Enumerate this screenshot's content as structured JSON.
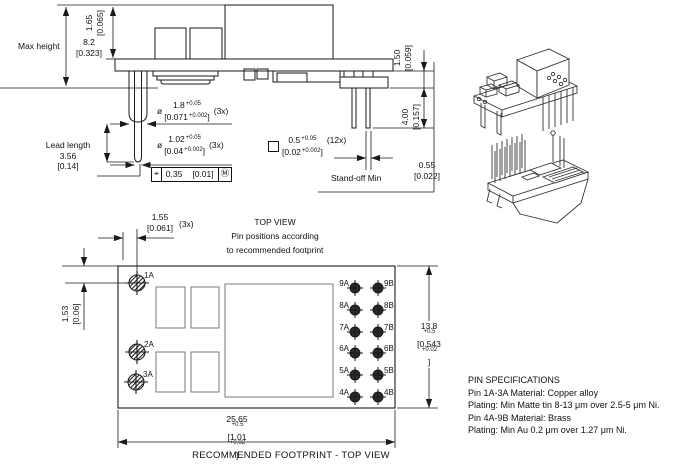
{
  "side_view": {
    "max_height_label": "Max height",
    "dim_board_top": {
      "mm": "1.65",
      "inch": "[0.065]"
    },
    "dim_max_height": {
      "mm": "8.2",
      "inch": "[0.323]"
    },
    "dim_board_right": {
      "mm": "1.50",
      "inch": "[0.059]"
    },
    "dim_pin_length": {
      "mm": "4.00",
      "inch": "[0.157]"
    },
    "lead_length": {
      "label": "Lead length",
      "mm": "3.56",
      "inch": "[0.14]"
    },
    "dia_large": {
      "symbol": "ø",
      "mm": [
        {
          "t": "1.8"
        },
        {
          "t": "+0.05",
          "sup": true
        }
      ],
      "inch": [
        {
          "t": "[0.071"
        },
        {
          "t": "+0.002",
          "sup": true
        },
        {
          "t": "]"
        }
      ],
      "count": "(3x)"
    },
    "dia_small": {
      "symbol": "ø",
      "mm": [
        {
          "t": "1.02"
        },
        {
          "t": "+0.05",
          "sup": true
        }
      ],
      "inch": [
        {
          "t": "[0.04"
        },
        {
          "t": "+0.002",
          "sup": true
        },
        {
          "t": "]"
        }
      ],
      "count": "(3x)"
    },
    "square_pin": {
      "mm": [
        {
          "t": "0.5"
        },
        {
          "t": "+0.05",
          "sup": true
        }
      ],
      "inch": [
        {
          "t": "[0.02"
        },
        {
          "t": "+0.002",
          "sup": true
        },
        {
          "t": "]"
        }
      ],
      "count": "(12x)"
    },
    "tolerance_frame": {
      "symbol": "⌖",
      "value": "0.35",
      "inch": "[0.01]",
      "modifier": "Ⓜ"
    },
    "standoff": {
      "label": "Stand-off Min",
      "mm": "0.55",
      "inch": "[0.022]"
    }
  },
  "top_view": {
    "title": "TOP VIEW",
    "subtitle_line1": "Pin positions according",
    "subtitle_line2": "to recommended footprint",
    "dim_pin_offset_x": {
      "mm": "1.55",
      "inch": "[0.061]",
      "count": "(3x)"
    },
    "dim_pin_offset_y": {
      "mm": "1.53",
      "inch": "[0.06]"
    },
    "dim_width": {
      "mm": [
        {
          "t": "13.8"
        },
        {
          "t": "+0.5",
          "sup": true
        }
      ],
      "inch": [
        {
          "t": "[0.543"
        },
        {
          "t": "+0.02",
          "sup": true
        },
        {
          "t": "]"
        }
      ]
    },
    "dim_length": {
      "mm": [
        {
          "t": "25.65"
        },
        {
          "t": "+0.5",
          "sup": true
        }
      ],
      "inch": [
        {
          "t": "[1.01"
        },
        {
          "t": "+0.02",
          "sup": true
        },
        {
          "t": "]"
        }
      ]
    },
    "caption": "RECOMMENDED FOOTPRINT - TOP VIEW",
    "left_pins": [
      "1A",
      "2A",
      "3A"
    ],
    "right_pins": [
      {
        "a": "9A",
        "b": "9B"
      },
      {
        "a": "8A",
        "b": "8B"
      },
      {
        "a": "7A",
        "b": "7B"
      },
      {
        "a": "6A",
        "b": "6B"
      },
      {
        "a": "5A",
        "b": "5B"
      },
      {
        "a": "4A",
        "b": "4B"
      }
    ]
  },
  "pin_specifications": {
    "title": "PIN SPECIFICATIONS",
    "lines": [
      "Pin 1A-3A Material: Copper alloy",
      "Plating: Min Matte tin 8-13 μm over 2.5-5 μm Ni.",
      "Pin 4A-9B Material: Brass",
      "Plating: Min Au 0.2 μm over 1.27 μm Ni."
    ]
  },
  "colors": {
    "line": "#1a1a1a",
    "background": "#ffffff"
  }
}
